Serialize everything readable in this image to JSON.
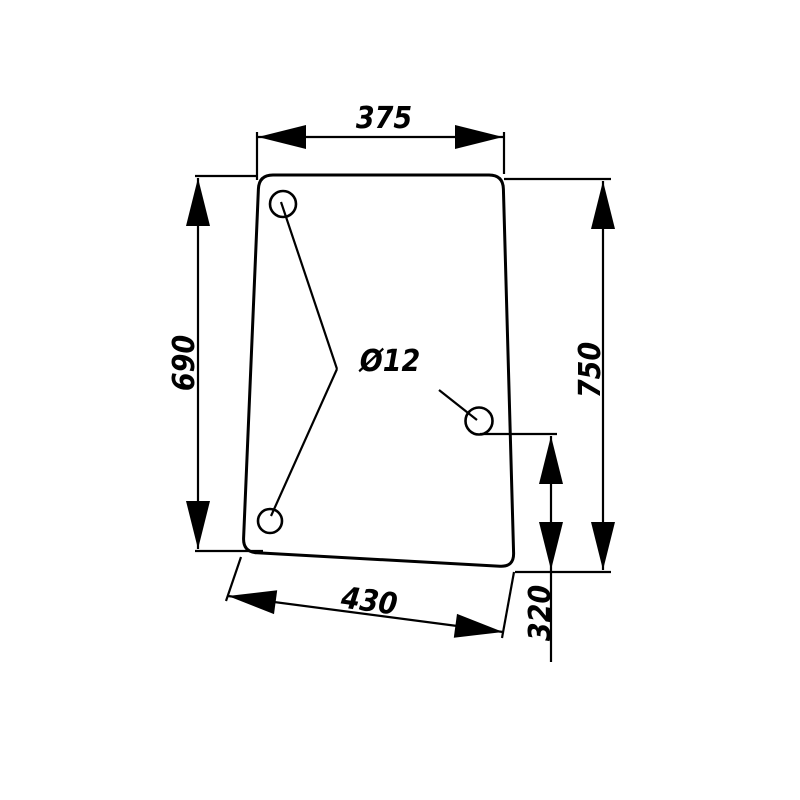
{
  "drawing": {
    "title": "glass-panel-dimension-drawing",
    "line_color": "#000000",
    "background_color": "#ffffff",
    "dimensions": {
      "top_width": "375",
      "left_height": "690",
      "right_height": "750",
      "bottom_width": "430",
      "hole_offset": "320",
      "hole_diameter": "Ø12"
    }
  }
}
